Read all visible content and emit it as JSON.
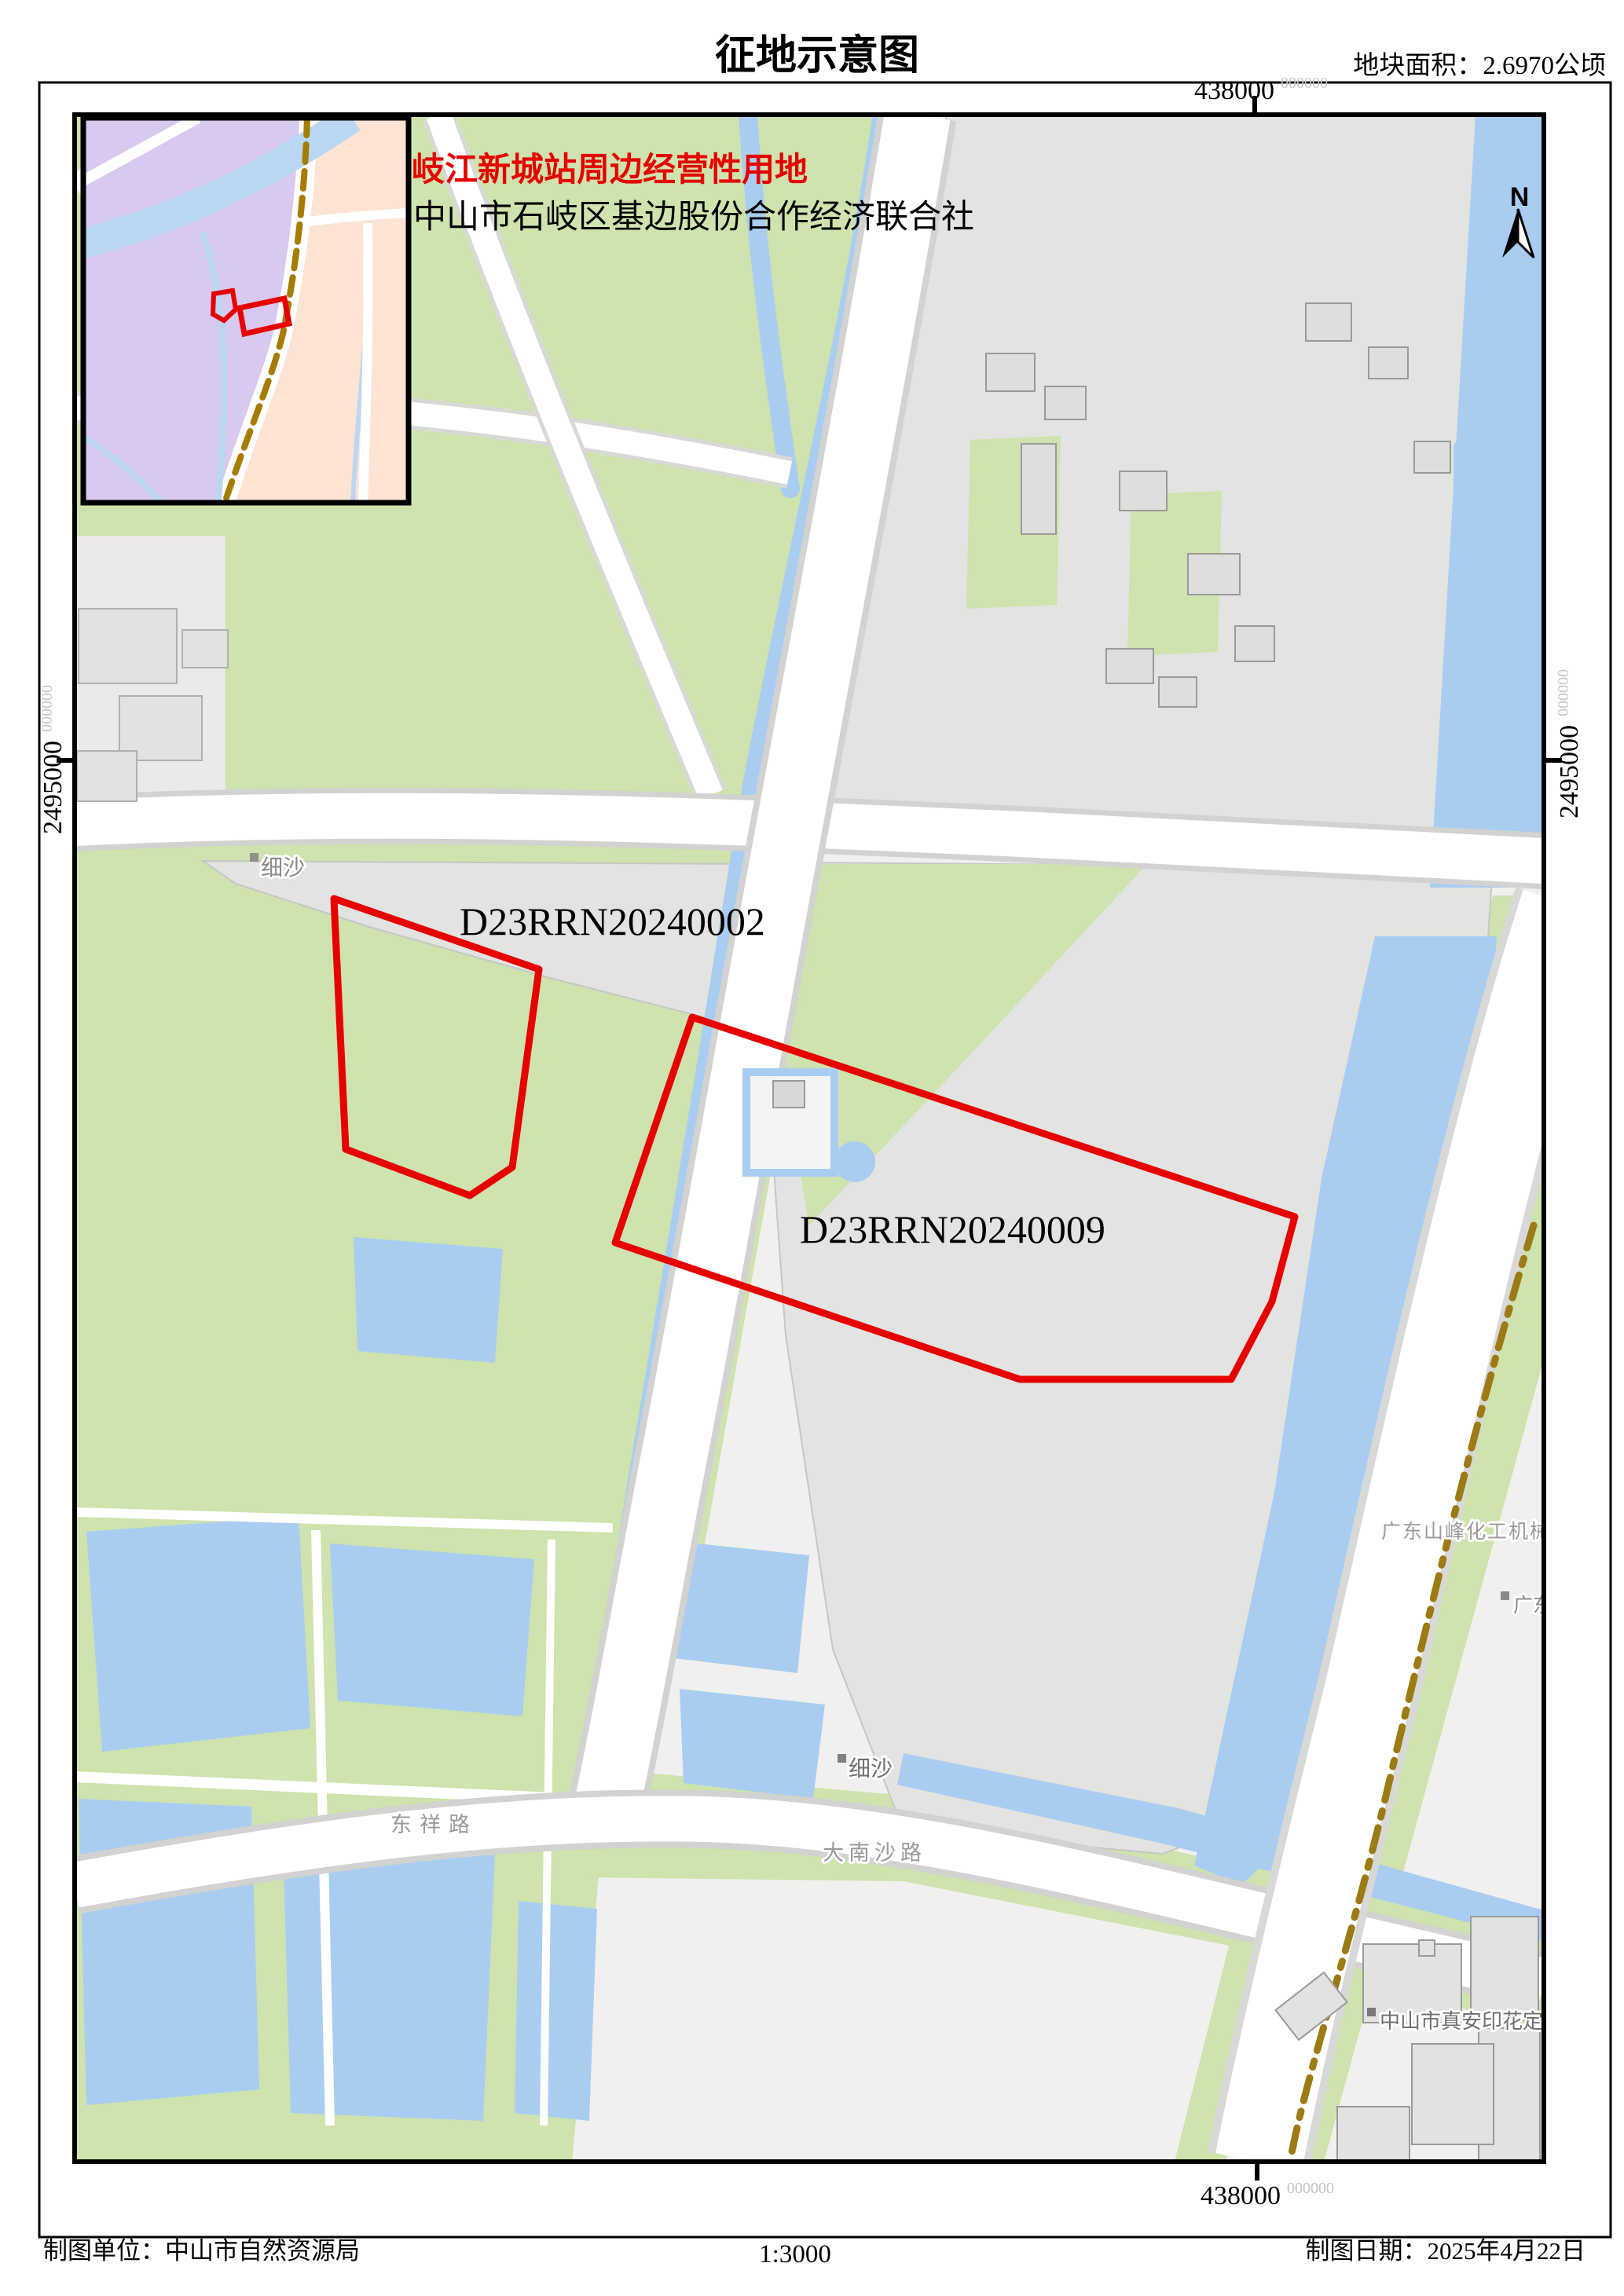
{
  "title": "征地示意图",
  "area_label": "地块面积：2.6970公顷",
  "annotations": {
    "line1": "岐江新城站周边经营性用地",
    "line2": "中山市石岐区基边股份合作经济联合社"
  },
  "parcels": {
    "p1": {
      "id": "D23RRN20240002"
    },
    "p2": {
      "id": "D23RRN20240009"
    }
  },
  "grid": {
    "x": "438000",
    "y": "2495000",
    "sup": "000000"
  },
  "north": {
    "label": "N"
  },
  "places": {
    "xisha_top": "细沙",
    "dongxiang_road": "东祥路",
    "danansha_road": "大南沙路",
    "xisha_bottom": "细沙",
    "chem_factory": "广东山峰化工机械有",
    "guangdong_partial": "广东",
    "print_factory": "中山市真安印花定型"
  },
  "footer": {
    "agency": "制图单位：中山市自然资源局",
    "scale": "1:3000",
    "date": "制图日期：2025年4月22日"
  },
  "colors": {
    "parcel_red": "#e60000",
    "green": "#cee3ad",
    "water": "#a9cdf1",
    "urban": "#e3e3e1",
    "inset_purple": "#d9c8ef",
    "inset_peach": "#fce3d4",
    "boundary_brown": "#9c7a14"
  }
}
